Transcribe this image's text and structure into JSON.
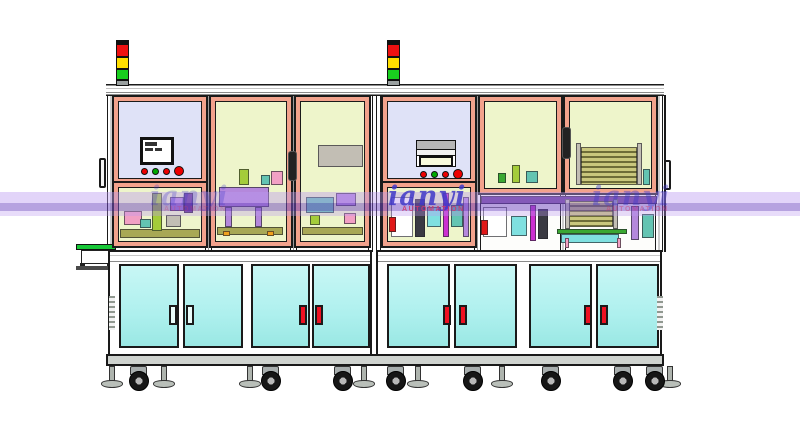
{
  "watermark": {
    "brand": "ianyi",
    "subtitle": "AUTOMATION",
    "band_color": "#9b6fe0",
    "text_color": "#4038c8",
    "subtitle_color": "#cc3a6e"
  },
  "palette": {
    "frame": "#f2a28c",
    "paneYellow": "#eef5cb",
    "paneLavender": "#dfe2f7",
    "doorCyan": "#aef0ee",
    "handleRed": "#ee1122",
    "towerRed": "#ee1111",
    "towerYellow": "#ffdf00",
    "towerGreen": "#19cf1f",
    "towerBase": "#9aa0a0",
    "baseGray": "#cfd3cf",
    "wmText": "#4038c8",
    "wmSub": "#cc3a6e",
    "purple": "#b488dc",
    "purpledk": "#5c2d91",
    "pink": "#f2a0c4",
    "magenta": "#cc2fd0",
    "teal": "#63c4b2",
    "cyanm": "#7fe0e0",
    "green": "#3aa832",
    "lime": "#a4cc3a",
    "olive": "#a8a855",
    "graym": "#c2beb4",
    "orange": "#f0a01e",
    "redm": "#e01818",
    "dark": "#3a3a42"
  },
  "machinery": {
    "l1": [
      {
        "x": 0,
        "y": 38,
        "w": 80,
        "h": 9,
        "c": "olive"
      },
      {
        "x": 32,
        "y": 2,
        "w": 10,
        "h": 38,
        "c": "lime"
      },
      {
        "x": 4,
        "y": 20,
        "w": 18,
        "h": 14,
        "c": "pink"
      },
      {
        "x": 50,
        "y": 6,
        "w": 14,
        "h": 14,
        "c": "purple"
      },
      {
        "x": 64,
        "y": 2,
        "w": 9,
        "h": 20,
        "c": "purpledk"
      },
      {
        "x": 20,
        "y": 28,
        "w": 11,
        "h": 9,
        "c": "teal"
      },
      {
        "x": 46,
        "y": 24,
        "w": 15,
        "h": 12,
        "c": "graym"
      }
    ],
    "l2": [
      {
        "x": 2,
        "y": 84,
        "w": 50,
        "h": 20,
        "c": "purple"
      },
      {
        "x": 8,
        "y": 104,
        "w": 7,
        "h": 20,
        "c": "purple"
      },
      {
        "x": 38,
        "y": 104,
        "w": 7,
        "h": 20,
        "c": "purple"
      },
      {
        "x": 0,
        "y": 124,
        "w": 66,
        "h": 8,
        "c": "olive"
      },
      {
        "x": 6,
        "y": 128,
        "w": 7,
        "h": 5,
        "c": "orange"
      },
      {
        "x": 50,
        "y": 128,
        "w": 7,
        "h": 5,
        "c": "orange"
      },
      {
        "x": 54,
        "y": 68,
        "w": 12,
        "h": 14,
        "c": "pink"
      },
      {
        "x": 22,
        "y": 66,
        "w": 10,
        "h": 16,
        "c": "lime"
      },
      {
        "x": 44,
        "y": 72,
        "w": 9,
        "h": 10,
        "c": "teal"
      }
    ],
    "l3": [
      {
        "x": 16,
        "y": 42,
        "w": 45,
        "h": 22,
        "c": "graym"
      },
      {
        "x": 4,
        "y": 94,
        "w": 28,
        "h": 16,
        "c": "teal"
      },
      {
        "x": 34,
        "y": 90,
        "w": 20,
        "h": 13,
        "c": "purple"
      },
      {
        "x": 0,
        "y": 124,
        "w": 61,
        "h": 8,
        "c": "olive"
      },
      {
        "x": 8,
        "y": 112,
        "w": 10,
        "h": 10,
        "c": "lime"
      },
      {
        "x": 42,
        "y": 110,
        "w": 12,
        "h": 11,
        "c": "pink"
      }
    ],
    "r1": [
      {
        "x": 2,
        "y": 6,
        "w": 22,
        "h": 40,
        "c": "whitem"
      },
      {
        "x": 0,
        "y": 26,
        "w": 7,
        "h": 15,
        "c": "redm"
      },
      {
        "x": 26,
        "y": 8,
        "w": 10,
        "h": 38,
        "c": "dark"
      },
      {
        "x": 38,
        "y": 16,
        "w": 14,
        "h": 20,
        "c": "cyanm"
      },
      {
        "x": 54,
        "y": 2,
        "w": 6,
        "h": 44,
        "c": "magenta"
      },
      {
        "x": 62,
        "y": 14,
        "w": 12,
        "h": 22,
        "c": "teal"
      },
      {
        "x": 74,
        "y": 6,
        "w": 6,
        "h": 40,
        "c": "purple"
      }
    ],
    "r2": [
      {
        "x": 26,
        "y": 62,
        "w": 8,
        "h": 18,
        "c": "lime"
      },
      {
        "x": 40,
        "y": 68,
        "w": 12,
        "h": 12,
        "c": "teal"
      },
      {
        "x": 12,
        "y": 70,
        "w": 8,
        "h": 10,
        "c": "green"
      }
    ],
    "r3": [
      {
        "x": 10,
        "y": 44,
        "w": 56,
        "h": 38,
        "c": "tray"
      },
      {
        "x": 5,
        "y": 40,
        "w": 5,
        "h": 42,
        "c": "graym"
      },
      {
        "x": 66,
        "y": 40,
        "w": 5,
        "h": 42,
        "c": "graym"
      },
      {
        "x": 72,
        "y": 66,
        "w": 7,
        "h": 16,
        "c": "teal"
      }
    ],
    "rlow": [
      {
        "x": 0,
        "y": 0,
        "w": 176,
        "h": 8,
        "c": "purpledk"
      },
      {
        "x": 2,
        "y": 11,
        "w": 24,
        "h": 30,
        "c": "whitem"
      },
      {
        "x": 0,
        "y": 24,
        "w": 7,
        "h": 15,
        "c": "redm"
      },
      {
        "x": 30,
        "y": 20,
        "w": 16,
        "h": 20,
        "c": "cyanm"
      },
      {
        "x": 49,
        "y": 9,
        "w": 6,
        "h": 36,
        "c": "magenta"
      },
      {
        "x": 57,
        "y": 13,
        "w": 10,
        "h": 30,
        "c": "dark"
      },
      {
        "x": 88,
        "y": 5,
        "w": 44,
        "h": 26,
        "c": "tray"
      },
      {
        "x": 84,
        "y": 3,
        "w": 5,
        "h": 30,
        "c": "graym"
      },
      {
        "x": 132,
        "y": 3,
        "w": 5,
        "h": 30,
        "c": "graym"
      },
      {
        "x": 76,
        "y": 33,
        "w": 70,
        "h": 5,
        "c": "green"
      },
      {
        "x": 80,
        "y": 38,
        "w": 58,
        "h": 9,
        "c": "cyanm"
      },
      {
        "x": 150,
        "y": 10,
        "w": 8,
        "h": 34,
        "c": "purple"
      },
      {
        "x": 161,
        "y": 18,
        "w": 12,
        "h": 24,
        "c": "teal"
      },
      {
        "x": 84,
        "y": 42,
        "w": 4,
        "h": 10,
        "c": "pink"
      },
      {
        "x": 136,
        "y": 42,
        "w": 4,
        "h": 10,
        "c": "pink"
      }
    ]
  },
  "undercarriage": {
    "feet": [
      100,
      152,
      238,
      352,
      406,
      490,
      658
    ],
    "casters": [
      126,
      258,
      330,
      383,
      460,
      538,
      610,
      642
    ]
  }
}
